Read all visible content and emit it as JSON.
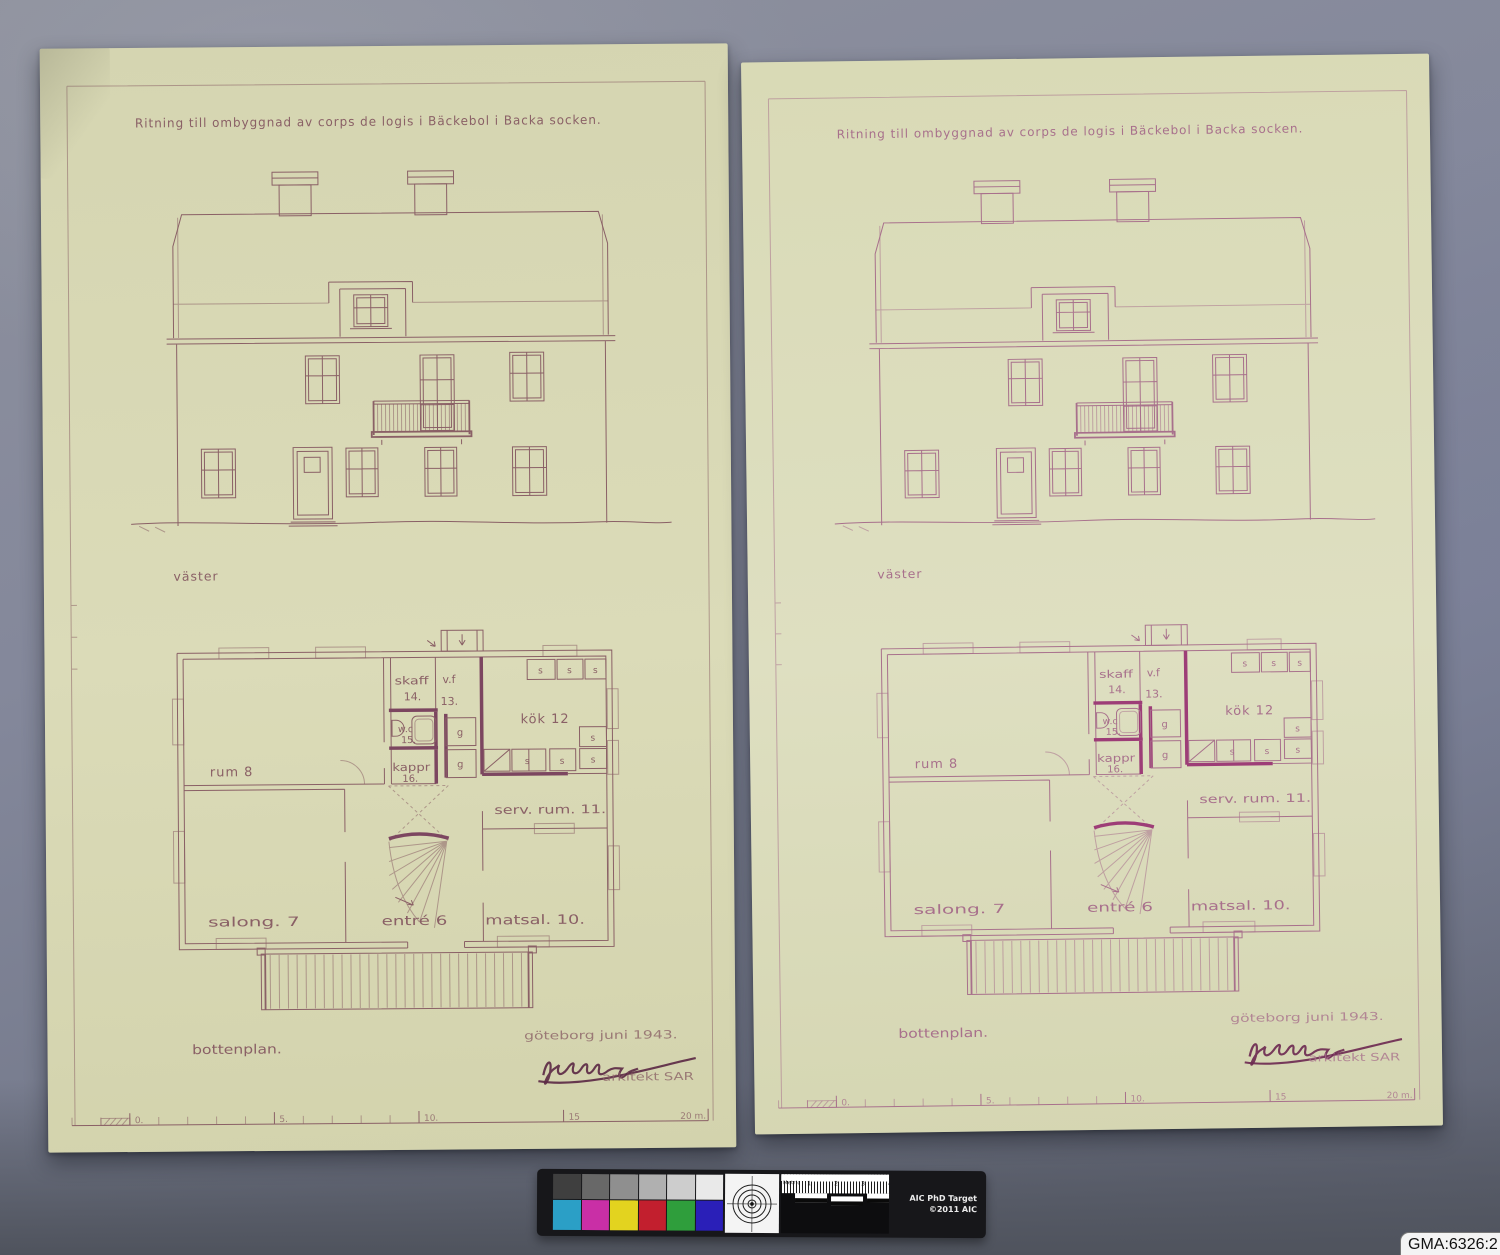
{
  "photo": {
    "catalog_label": "GMA:6326:2",
    "colors": {
      "backdrop": "#7d8294",
      "paper_left": "#d8d8b5",
      "paper_right": "#dbdcbd",
      "ink_left": "#8a6066",
      "ink_right": "#a8708c",
      "accent_wall_left": "#7c4660",
      "accent_wall_right": "#9d3d77"
    }
  },
  "sheet": {
    "title": "Ritning till ombyggnad av corps de logis i Bäckebol i Backa socken.",
    "elevation_label": "väster",
    "plan_label": "bottenplan.",
    "place_date": "göteborg  juni  1943.",
    "architect": "arkitekt SAR",
    "rooms": {
      "rum": "rum 8",
      "salong": "salong. 7",
      "entre": "entré 6",
      "matsal": "matsal. 10.",
      "serv": "serv. rum. 11.",
      "kok": "kök 12",
      "vf": "v.f",
      "vf_no": "13.",
      "skaff": "skaff",
      "skaff_no": "14.",
      "wc": "w.c",
      "wc_no": "15.",
      "kappr": "kappr",
      "kappr_no": "16.",
      "closet_s": "s",
      "closet_g": "g"
    },
    "scale_ticks": [
      "0.",
      "5.",
      "10.",
      "15",
      "20 m."
    ]
  },
  "color_target": {
    "name_line1": "AIC PhD Target",
    "name_line2": "©2011 AIC",
    "ruler_label": "Metric",
    "ruler_numbers": [
      "1",
      "2",
      "3",
      "4",
      "5"
    ],
    "gray_patches": [
      "#3f3f3f",
      "#686868",
      "#8f8f8f",
      "#b0b0b0",
      "#cdcdcd",
      "#e9e9e9"
    ],
    "color_patches": [
      "#2b9fc6",
      "#c92fa6",
      "#e3d31f",
      "#c21f2e",
      "#2f9e3c",
      "#2a1fb8"
    ]
  }
}
